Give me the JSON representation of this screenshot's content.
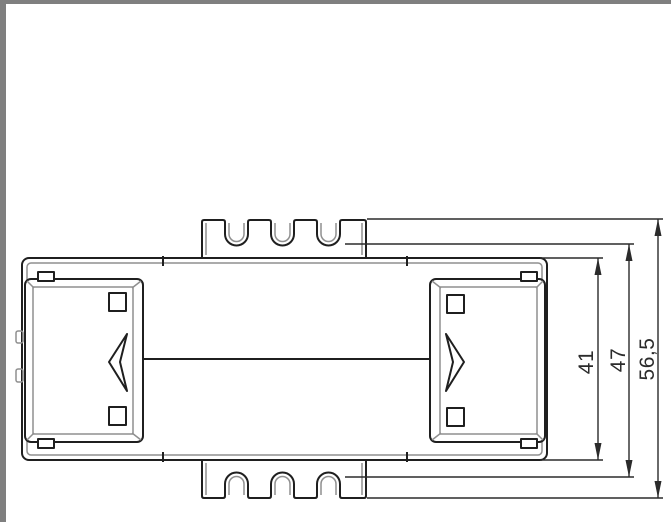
{
  "window": {
    "frame_color": "#7f7f7f",
    "canvas_color": "#ffffff"
  },
  "drawing": {
    "type": "technical-dimension-drawing",
    "view": "top-view-din-rail-device",
    "colors": {
      "primary_line": "#1f1f1f",
      "secondary_line": "#8f8f8f",
      "dimension_line": "#2b2b2b"
    },
    "dimensions": [
      {
        "label": "41"
      },
      {
        "label": "47"
      },
      {
        "label": "56,5"
      }
    ]
  }
}
